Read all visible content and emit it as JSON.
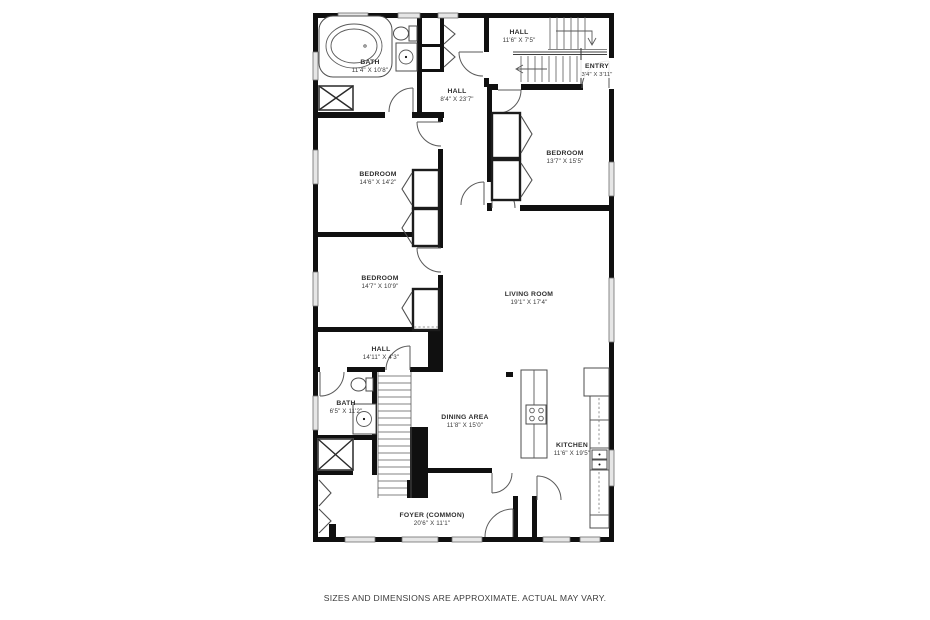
{
  "colors": {
    "wall": "#101010",
    "window_fill": "#e6e6e6",
    "line": "#5a5a5a",
    "text": "#2e2e2e",
    "background": "#ffffff"
  },
  "rooms": {
    "bath_top": {
      "name": "BATH",
      "dims": "11'4\" X 10'8\""
    },
    "hall_top": {
      "name": "HALL",
      "dims": "11'6\" X 7'5\""
    },
    "entry": {
      "name": "ENTRY",
      "dims": "3'4\" X 3'11\""
    },
    "hall_main": {
      "name": "HALL",
      "dims": "8'4\" X 23'7\""
    },
    "bedroom_left_upper": {
      "name": "BEDROOM",
      "dims": "14'6\" X 14'2\""
    },
    "bedroom_right": {
      "name": "BEDROOM",
      "dims": "13'7\" X 15'5\""
    },
    "bedroom_left_lower": {
      "name": "BEDROOM",
      "dims": "14'7\" X 10'9\""
    },
    "living_room": {
      "name": "LIVING ROOM",
      "dims": "19'1\" X 17'4\""
    },
    "hall_lower": {
      "name": "HALL",
      "dims": "14'11\" X 4'3\""
    },
    "bath_lower": {
      "name": "BATH",
      "dims": "6'5\" X 11'2\""
    },
    "dining": {
      "name": "DINING AREA",
      "dims": "11'8\" X 15'0\""
    },
    "kitchen": {
      "name": "KITCHEN",
      "dims": "11'6\" X 19'5\""
    },
    "foyer": {
      "name": "FOYER (COMMON)",
      "dims": "20'6\" X 11'1\""
    }
  },
  "footer": {
    "disclaimer": "SIZES AND DIMENSIONS ARE APPROXIMATE. ACTUAL MAY VARY."
  }
}
